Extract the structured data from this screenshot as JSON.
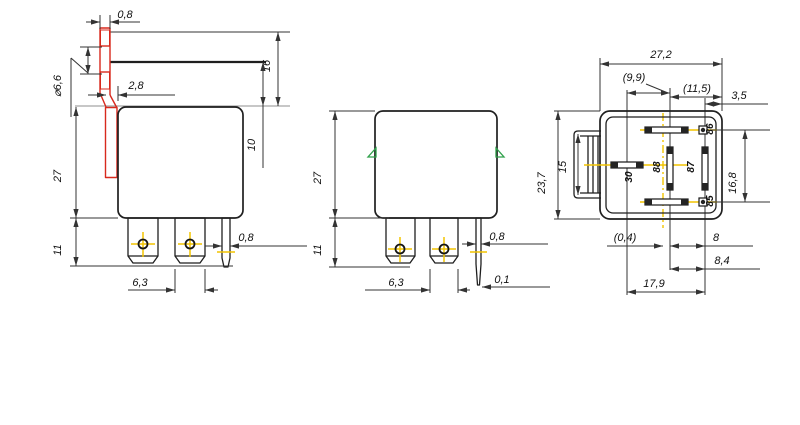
{
  "views": {
    "side_with_bracket": {
      "dims": {
        "bracket_thickness": "0,8",
        "bracket_top_to_body": "16",
        "bracket_offset": "2,8",
        "hole_diameter": "⌀6,6",
        "line_to_body": "10",
        "body_height": "27",
        "pin_length": "11",
        "blade_width": "6,3",
        "pin_thickness": "0,8"
      }
    },
    "side_plain": {
      "dims": {
        "body_height": "27",
        "pin_length": "11",
        "blade_width": "6,3",
        "pin_thickness": "0,8",
        "tip_thickness": "0,1"
      }
    },
    "bottom": {
      "dims": {
        "body_width": "27,2",
        "center_offset": "(9,9)",
        "right_offset": "(11,5)",
        "edge_offset": "3,5",
        "body_height": "23,7",
        "bracket_height": "15",
        "coil_pin_span": "16,8",
        "center_deviation": "(0,4)",
        "offset_8": "8",
        "offset_8_4": "8,4",
        "pin_span": "17,9"
      },
      "pin_labels": {
        "p30": "30",
        "p85": "85",
        "p86": "86",
        "p87": "87",
        "p88": "88"
      }
    }
  },
  "colors": {
    "line": "#1f1f1f",
    "dimension": "#333333",
    "bracket_red": "#d8291d",
    "centerline_yellow": "#f2c400",
    "mark_green": "#2fa04a",
    "construction_gray": "#8f8f8f"
  }
}
